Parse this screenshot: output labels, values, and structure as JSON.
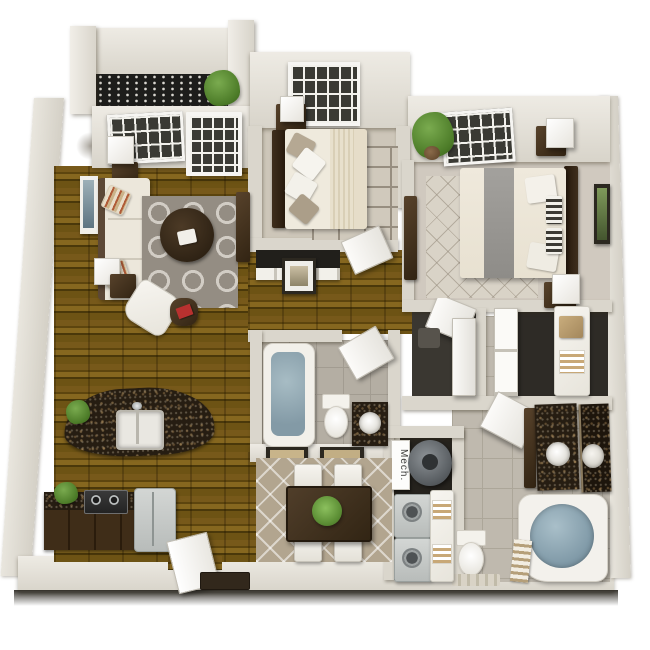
{
  "labels": {
    "mech": "Mech."
  },
  "palette": {
    "background": "#ffffff",
    "wall_face": "#dedad1",
    "wall_top": "#efece6",
    "wall_shadow": "#b5b0a5",
    "wood_floor": "#6b5314",
    "wood_floor_dark": "#4a380a",
    "carpet": "#cdc6b9",
    "tile": "#b4aea3",
    "tile_light": "#bfb9ae",
    "granite_counter": "#261d12",
    "rug_gray": "#948d83",
    "rug_beige": "#b2a58f",
    "rug_light": "#d9d3c7",
    "sofa_cream": "#eae5d9",
    "dark_wood_furniture": "#46341f",
    "tub_water_blue": "#8ba3af",
    "plant_green": "#5d8c39",
    "appliance_gray": "#c3c6c4",
    "accent_red_book": "#b8312f",
    "balcony_lattice": "#1d1d1b"
  }
}
